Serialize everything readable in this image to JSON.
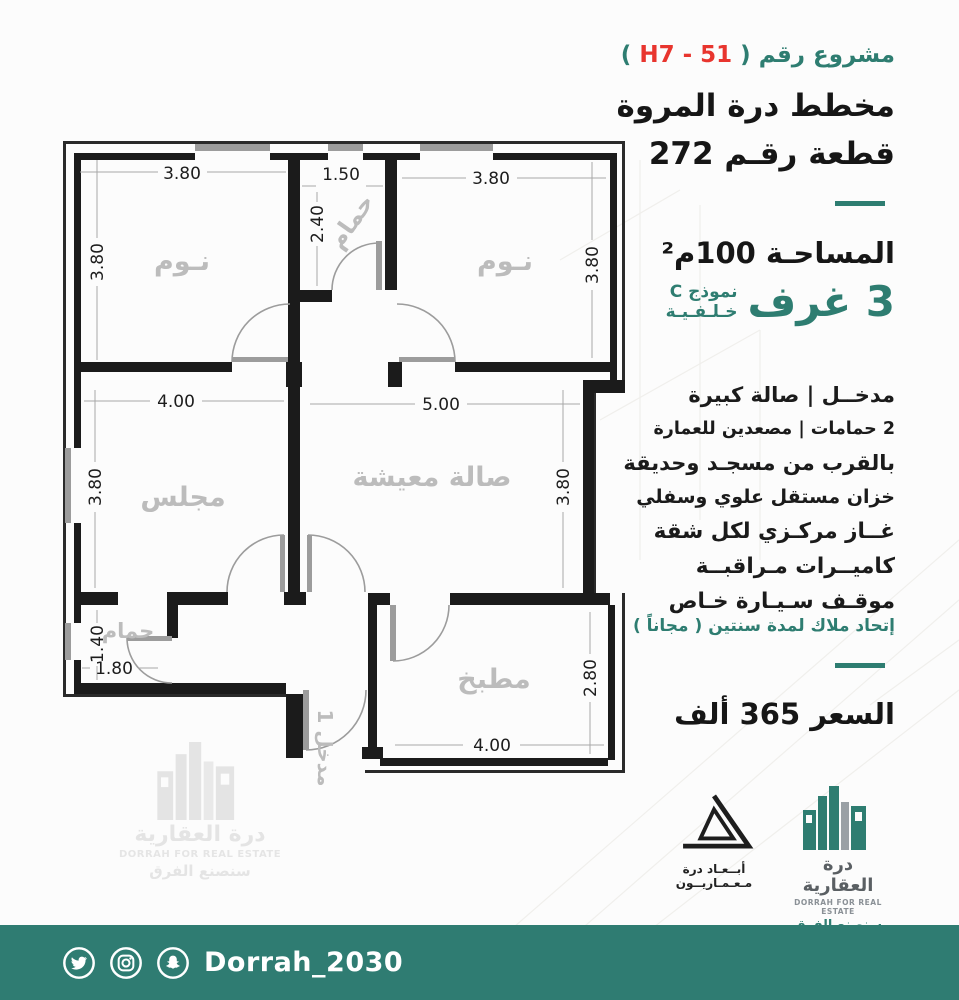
{
  "accent": "#2e7d71",
  "header": {
    "project_prefix": "مشروع رقم (",
    "project_code": " H7 - 51 ",
    "project_suffix": ")",
    "title_line1": "مخطط درة المروة",
    "title_line2": "قطعة رقـم 272"
  },
  "specs": {
    "area": "المساحـة 100م²",
    "rooms_count": "3 غرف",
    "model": "نموذج C",
    "model_sub": "خـلـفـيـة"
  },
  "features": {
    "lines": [
      "مدخــل   |   صالة كبيرة",
      "2 حمامات  |  مصعدين للعمارة",
      "بالقرب من مسجـد وحديقة",
      "خزان مستقل علوي وسفلي",
      "غــاز مركـزي لكل شقة",
      "كاميــرات مـراقبــة",
      "موقـف سـيـارة خـاص"
    ],
    "note": "إتحاد ملاك لمدة سنتين ( مجاناً )"
  },
  "price": "السعر  365  ألف",
  "logos": {
    "abaad": {
      "line1": "أبــعـاد درة",
      "line2": "مـعـمـاريــون"
    },
    "dorrah": {
      "name_ar": "درة العقارية",
      "name_en": "DORRAH FOR REAL ESTATE",
      "slogan": "سنصنع الفرق"
    }
  },
  "watermark": {
    "name_ar": "درة العقارية",
    "name_en": "DORRAH FOR REAL ESTATE",
    "slogan": "سنصنع الفرق"
  },
  "footer": {
    "handle": "Dorrah_2030",
    "icons": [
      "twitter-icon",
      "instagram-icon",
      "snapchat-icon"
    ]
  },
  "plan": {
    "rooms": [
      {
        "label": "نـوم",
        "w": "3.80",
        "h": "3.80"
      },
      {
        "label": "حمام",
        "w": "1.50",
        "h": "2.40"
      },
      {
        "label": "نـوم",
        "w": "3.80",
        "h": "3.80"
      },
      {
        "label": "مجلس",
        "w": "4.00",
        "h": "3.80"
      },
      {
        "label": "صالة معيشة",
        "w": "5.00",
        "h": "3.80"
      },
      {
        "label": "حمام",
        "w": "1.80",
        "h": "1.40"
      },
      {
        "label": "مطبخ",
        "w": "4.00",
        "h": "2.80"
      },
      {
        "label": "مدخل 1"
      }
    ]
  }
}
